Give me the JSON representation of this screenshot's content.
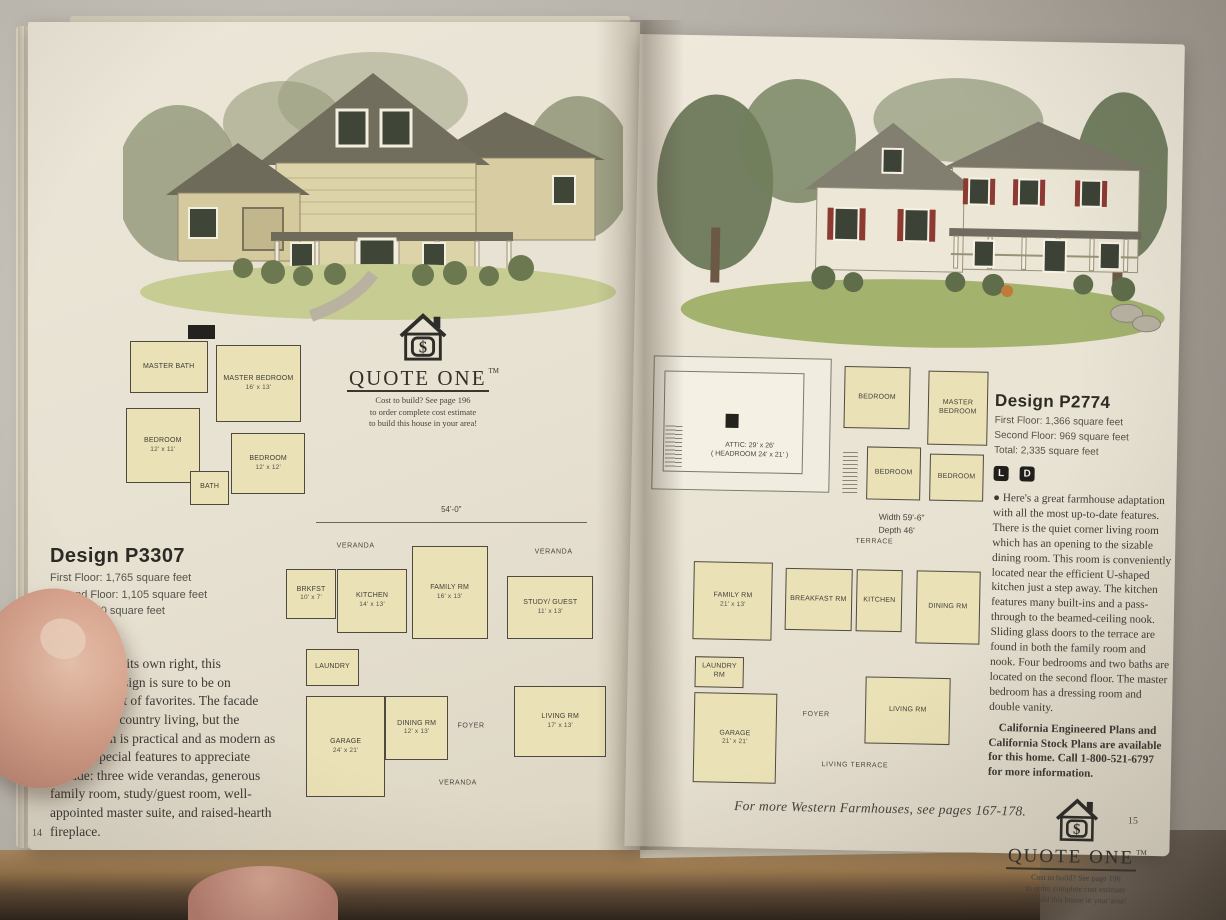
{
  "scene": {
    "left_page_number": "14",
    "right_page_number": "15",
    "footer": "For more Western Farmhouses, see pages 167-178."
  },
  "quote_one": {
    "icon": "house-dollar-icon",
    "wordmark": "QUOTE ONE",
    "tm": "TM",
    "line1": "Cost to build? See page 196",
    "line2": "to order complete cost estimate",
    "line3": "to build this house in your area!"
  },
  "left": {
    "design": {
      "title": "Design P3307",
      "stats": [
        "First Floor: 1,765 square feet",
        "Second Floor: 1,105 square feet",
        "Total: 2,870 square feet"
      ],
      "badge_l": "L",
      "badge_d": "D",
      "body": "●  A classic in its own right, this farmhouse design is sure to be on everyone's list of favorites. The facade says simple, country living, but the interior plan is practical and as modern as can be.  Special features to appreciate include: three wide verandas, generous family room, study/guest room, well-appointed master suite, and raised-hearth fireplace."
    },
    "upper_plan": {
      "rooms": {
        "master_bath": {
          "name": "MASTER BATH"
        },
        "master_bedroom": {
          "name": "MASTER BEDROOM",
          "dims": "16' x 13'"
        },
        "bedroom1": {
          "name": "BEDROOM",
          "dims": "12' x 11'"
        },
        "bedroom2": {
          "name": "BEDROOM",
          "dims": "12' x 12'"
        },
        "bath": {
          "name": "BATH"
        }
      }
    },
    "main_plan": {
      "width_label": "54'-0\"",
      "veranda": "VERANDA",
      "rooms": {
        "brkfst": {
          "name": "BRKFST",
          "dims": "10' x 7'"
        },
        "kitchen": {
          "name": "KITCHEN",
          "dims": "14' x 13'"
        },
        "family": {
          "name": "FAMILY RM",
          "dims": "16' x 13'"
        },
        "study": {
          "name": "STUDY/ GUEST",
          "dims": "11' x 13'"
        },
        "laundry": {
          "name": "LAUNDRY"
        },
        "dining": {
          "name": "DINING RM",
          "dims": "12' x 13'"
        },
        "foyer": {
          "name": "FOYER"
        },
        "living": {
          "name": "LIVING RM",
          "dims": "17' x 13'"
        },
        "garage": {
          "name": "GARAGE",
          "dims": "24' x 21'"
        }
      }
    }
  },
  "right": {
    "design": {
      "title": "Design P2774",
      "stats": [
        "First Floor: 1,366 square feet",
        "Second Floor: 969 square feet",
        "Total: 2,335 square feet"
      ],
      "badge_l": "L",
      "badge_d": "D",
      "body": "●  Here's a great farmhouse adaptation with all the most up-to-date features. There is the quiet corner living room which has an opening to the sizable dining room. This room is conveniently located near the efficient U-shaped kitchen just a step away. The kitchen features many built-ins and a pass-through to the beamed-ceiling nook. Sliding glass doors to the terrace are found in both the family room and nook. Four bedrooms and two baths are located on the second floor. The master bedroom has a dressing room and double vanity.",
      "body2": "California Engineered Plans and California Stock Plans are available for this home. Call 1-800-521-6797 for more information."
    },
    "attic_plan": {
      "label1": "ATTIC: 29' x 26'",
      "label2": "( HEADROOM 24' x 21' )"
    },
    "upper_plan": {
      "rooms": {
        "bedroom_tl": {
          "name": "BEDROOM"
        },
        "master": {
          "name": "MASTER BEDROOM"
        },
        "bedroom_bl": {
          "name": "BEDROOM"
        },
        "bedroom_br": {
          "name": "BEDROOM"
        }
      }
    },
    "main_plan": {
      "size_label1": "Width 59'-6\"",
      "size_label2": "Depth 46'",
      "rooms": {
        "terrace": {
          "name": "TERRACE"
        },
        "family": {
          "name": "FAMILY RM",
          "dims": "21' x 13'"
        },
        "breakfast": {
          "name": "BREAKFAST RM"
        },
        "kitchen": {
          "name": "KITCHEN"
        },
        "dining": {
          "name": "DINING RM"
        },
        "laundry": {
          "name": "LAUNDRY RM"
        },
        "foyer": {
          "name": "FOYER"
        },
        "living": {
          "name": "LIVING RM"
        },
        "garage": {
          "name": "GARAGE",
          "dims": "21' x 21'"
        },
        "living_terrace": {
          "name": "LIVING TERRACE"
        }
      }
    }
  }
}
